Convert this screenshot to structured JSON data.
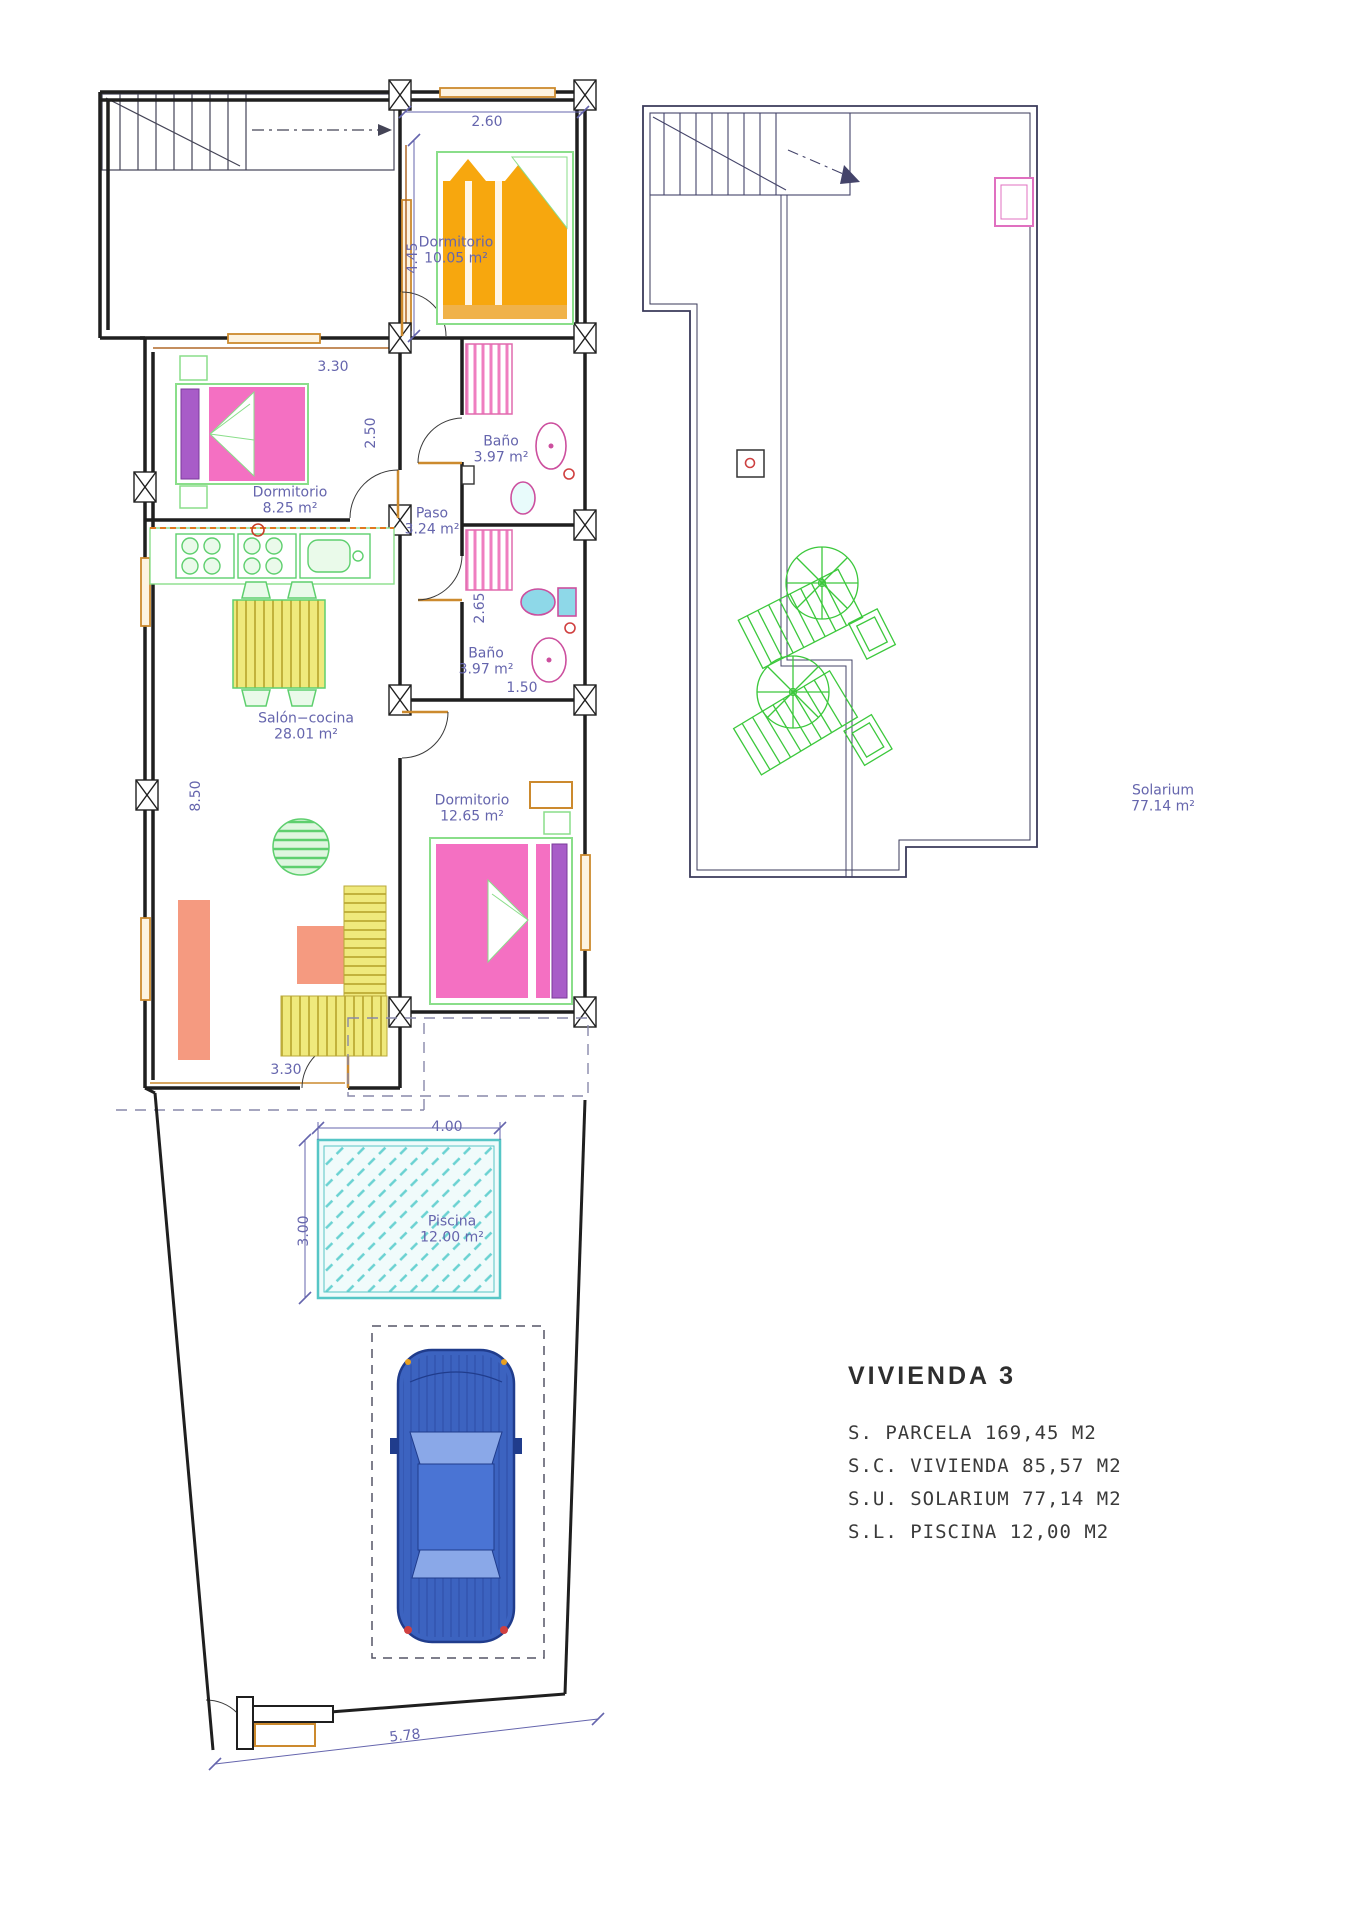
{
  "ground_floor": {
    "rooms": {
      "dormitorio1": {
        "name": "Dormitorio",
        "area": "10.05 m²"
      },
      "dormitorio2": {
        "name": "Dormitorio",
        "area": "8.25 m²"
      },
      "bano1": {
        "name": "Baño",
        "area": "3.97 m²"
      },
      "paso": {
        "name": "Paso",
        "area": "3.24 m²"
      },
      "bano2": {
        "name": "Baño",
        "area": "3.97 m²"
      },
      "salon": {
        "name": "Salón−cocina",
        "area": "28.01 m²"
      },
      "dormitorio3": {
        "name": "Dormitorio",
        "area": "12.65 m²"
      },
      "piscina": {
        "name": "Piscina",
        "area": "12.00 m²"
      }
    },
    "dimensions": {
      "d260": "2.60",
      "d445": "4.45",
      "d330a": "3.30",
      "d250": "2.50",
      "d265": "2.65",
      "d150": "1.50",
      "d850": "8.50",
      "d330b": "3.30",
      "d400": "4.00",
      "d300": "3.00",
      "d578": "5.78"
    }
  },
  "roof_plan": {
    "solarium": {
      "name": "Solarium",
      "area": "77.14 m²"
    }
  },
  "summary": {
    "title": "VIVIENDA 3",
    "lines": [
      "S. PARCELA 169,45 M2",
      "S.C. VIVIENDA 85,57 M2",
      "S.U. SOLARIUM 77,14 M2",
      "S.L. PISCINA 12,00 M2"
    ]
  },
  "colors": {
    "dimension_text": "#6565ad",
    "wall": "#1f1f1f",
    "furniture_green": "#8ade8a",
    "bed_orange": "#f7a70e",
    "bed_pink": "#f470c2",
    "pillow_purple": "#a85cc8",
    "pool_cyan": "#56c6c6",
    "sofa_yellow": "#efe97c",
    "rug_salmon": "#f59a80",
    "car_blue": "#3c63c0",
    "door_orange": "#cc8a2e",
    "fixture_pink": "#cc4f9e",
    "umbrella_green": "#3cc83c"
  }
}
